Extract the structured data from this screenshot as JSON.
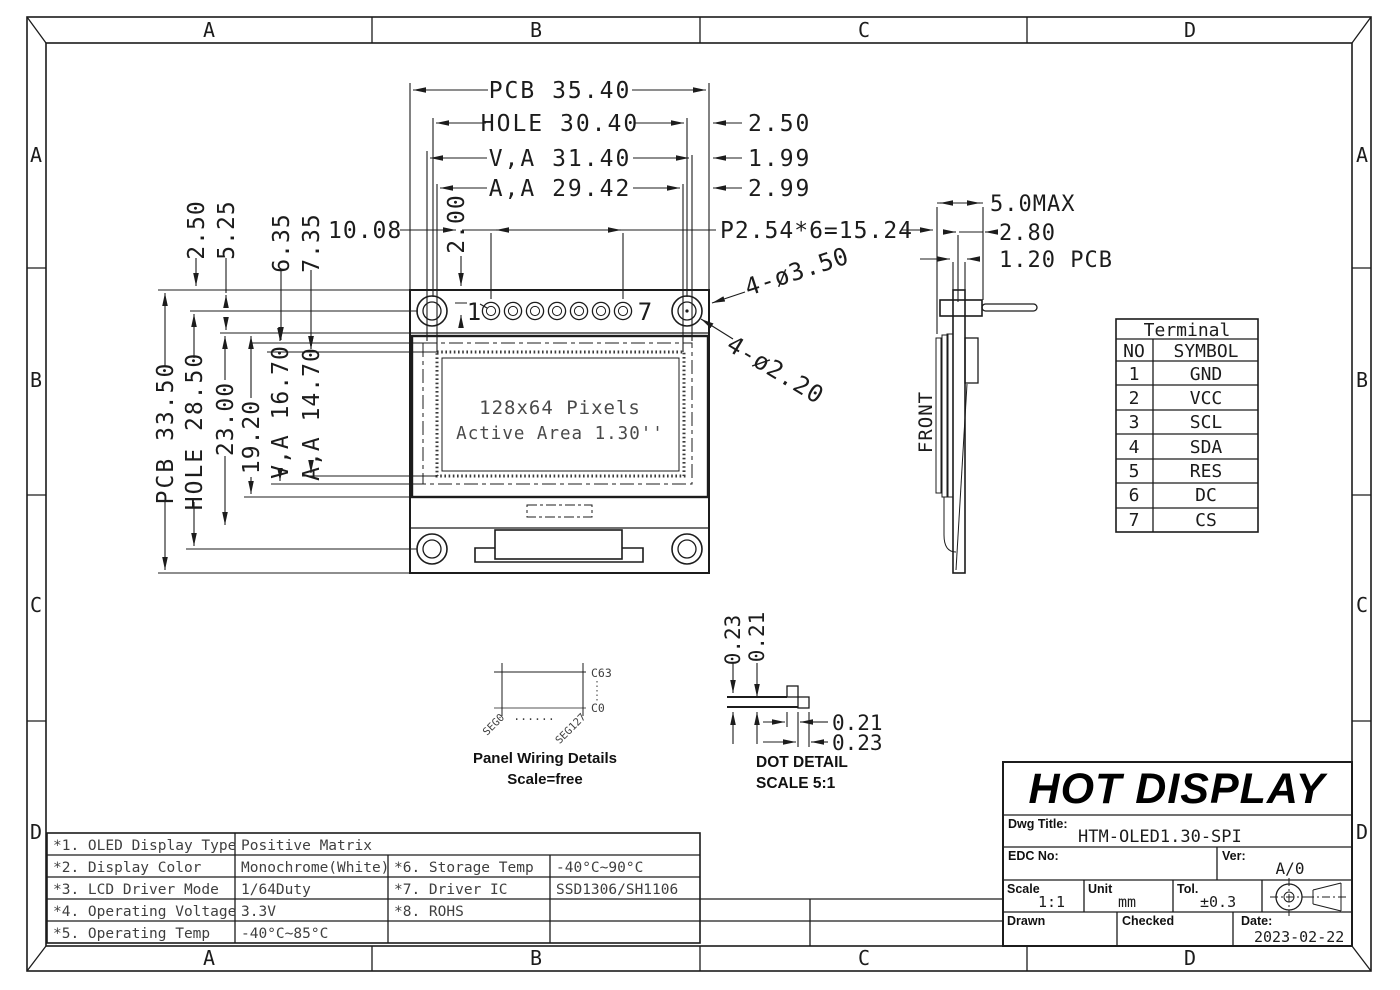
{
  "frame": {
    "zones": [
      "A",
      "B",
      "C",
      "D"
    ]
  },
  "front_view": {
    "display_line1": "128x64 Pixels",
    "display_line2": "Active Area 1.30''",
    "pin_first": "1",
    "pin_last": "7"
  },
  "dims": {
    "pcb_w": "PCB 35.40",
    "hole_w": "HOLE 30.40",
    "va_w": "V,A 31.40",
    "aa_w": "A,A 29.42",
    "off_hole": "2.50",
    "off_va": "1.99",
    "off_aa": "2.99",
    "pitch": "P2.54*6=15.24",
    "pin_top": "2.00",
    "pin_left": "10.08",
    "top_off": "2.50",
    "hole_top": "5.25",
    "va_top": "6.35",
    "aa_top": "7.35",
    "pcb_h": "PCB 33.50",
    "hole_h": "HOLE 28.50",
    "glass_h": "23.00",
    "mod_h": "19.20",
    "va_h": "V,A 16.70",
    "aa_h": "A,A 14.70",
    "callout_pad": "4-ø3.50",
    "callout_hole": "4-ø2.20",
    "thick_max": "5.0MAX",
    "thick_mod": "2.80",
    "thick_pcb": "1.20 PCB",
    "front_label": "FRONT"
  },
  "terminal": {
    "title": "Terminal",
    "col_no": "NO",
    "col_symbol": "SYMBOL",
    "rows": [
      {
        "no": "1",
        "sym": "GND"
      },
      {
        "no": "2",
        "sym": "VCC"
      },
      {
        "no": "3",
        "sym": "SCL"
      },
      {
        "no": "4",
        "sym": "SDA"
      },
      {
        "no": "5",
        "sym": "RES"
      },
      {
        "no": "6",
        "sym": "DC"
      },
      {
        "no": "7",
        "sym": "CS"
      }
    ]
  },
  "panel_wiring": {
    "c63": "C63",
    "c0": "C0",
    "seg0": "SEG0",
    "seg127": "SEG127",
    "dots": "......",
    "title": "Panel Wiring Details",
    "subtitle": "Scale=free"
  },
  "dot_detail": {
    "v_outer": "0.23",
    "v_inner": "0.21",
    "h_inner": "0.21",
    "h_outer": "0.23",
    "title": "DOT DETAIL",
    "subtitle": "SCALE 5:1"
  },
  "spec": {
    "rows": [
      {
        "k1": "*1. OLED Display Type",
        "v1": "Positive Matrix",
        "k2": "",
        "v2": ""
      },
      {
        "k1": "*2. Display Color",
        "v1": "Monochrome(White)",
        "k2": "*6. Storage Temp",
        "v2": "-40°C~90°C"
      },
      {
        "k1": "*3. LCD Driver Mode",
        "v1": "1/64Duty",
        "k2": "*7. Driver IC",
        "v2": "SSD1306/SH1106"
      },
      {
        "k1": "*4. Operating Voltage",
        "v1": "3.3V",
        "k2": "*8. ROHS",
        "v2": ""
      },
      {
        "k1": "*5. Operating Temp",
        "v1": "-40°C~85°C",
        "k2": "",
        "v2": ""
      }
    ]
  },
  "title_block": {
    "company": "HOT DISPLAY",
    "dwg_title_label": "Dwg Title:",
    "dwg_title": "HTM-OLED1.30-SPI",
    "edc_label": "EDC No:",
    "ver_label": "Ver:",
    "ver": "A/0",
    "scale_label": "Scale",
    "scale": "1:1",
    "unit_label": "Unit",
    "unit": "mm",
    "tol_label": "Tol.",
    "tol": "±0.3",
    "drawn_label": "Drawn",
    "checked_label": "Checked",
    "date_label": "Date:",
    "date": "2023-02-22"
  }
}
